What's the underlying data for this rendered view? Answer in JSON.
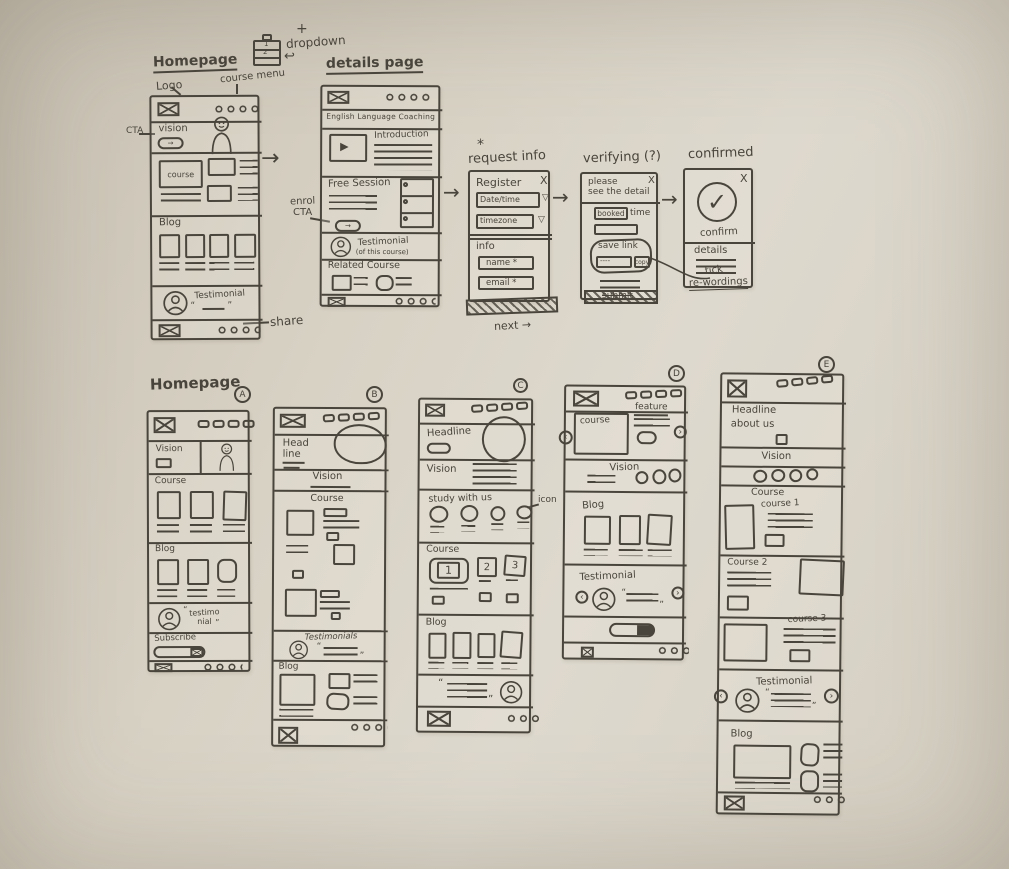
{
  "colors": {
    "paper": "#d8d2c5",
    "ink": "#4a453c"
  },
  "glyphs": {
    "plus": "+",
    "curl": "↩",
    "arrow": "→",
    "play": "▶",
    "caret": "▽",
    "check": "✓",
    "close": "X",
    "star": "*",
    "quote_open": "“",
    "quote_close": "”",
    "chev_left": "‹",
    "chev_right": "›",
    "dashes": "----"
  },
  "top": {
    "dropdown": {
      "label": "dropdown",
      "row1": "1",
      "row2": "2"
    },
    "homepage": {
      "title": "Homepage",
      "logo_note": "Logo",
      "menu_note": "course menu",
      "cta_note": "CTA",
      "share_note": "share",
      "vision": "vision",
      "course": "course",
      "blog": "Blog",
      "testimonial": "Testimonial"
    },
    "details": {
      "title": "details page",
      "heading": "English Language Coaching",
      "introduction": "Introduction",
      "free_session": "Free Session",
      "enrol_note1": "enrol",
      "enrol_note2": "CTA",
      "testimonial": "Testimonial",
      "testimonial_sub": "(of this course)",
      "related": "Related Course"
    },
    "request": {
      "note": "request info",
      "register": "Register",
      "date_time": "Date/time",
      "timezone": "timezone",
      "info": "info",
      "name": "name *",
      "email": "email *",
      "next": "next →"
    },
    "verifying": {
      "title": "verifying (?)",
      "line1": "please",
      "line2": "see the detail",
      "booked": "booked",
      "time": "time",
      "save_link": "save link",
      "copy": "copy",
      "submit": "submit"
    },
    "confirmed": {
      "title": "confirmed",
      "confirm": "confirm",
      "details": "details",
      "note1": "tick",
      "note2": "re-wordings"
    }
  },
  "bottom": {
    "title": "Homepage",
    "a": {
      "badge": "A",
      "vision": "Vision",
      "course": "Course",
      "blog": "Blog",
      "testi1": "testimo",
      "testi2": "nial",
      "subscribe": "Subscribe"
    },
    "b": {
      "badge": "B",
      "head1": "Head",
      "head2": "line",
      "vision": "Vision",
      "course": "Course",
      "testimonials": "Testimonials",
      "blog": "Blog"
    },
    "c": {
      "badge": "C",
      "headline": "Headline",
      "vision": "Vision",
      "study": "study with us",
      "icon_note": "icon",
      "course": "Course",
      "n1": "1",
      "n2": "2",
      "n3": "3",
      "blog": "Blog"
    },
    "d": {
      "badge": "D",
      "course": "course",
      "feature": "feature",
      "vision": "Vision",
      "blog": "Blog",
      "testimonial": "Testimonial"
    },
    "e": {
      "badge": "E",
      "head1": "Headline",
      "head2": "about us",
      "vision": "Vision",
      "course": "Course",
      "c1": "course 1",
      "c2": "Course 2",
      "c3": "course 3",
      "testimonial": "Testimonial",
      "blog": "Blog"
    }
  }
}
